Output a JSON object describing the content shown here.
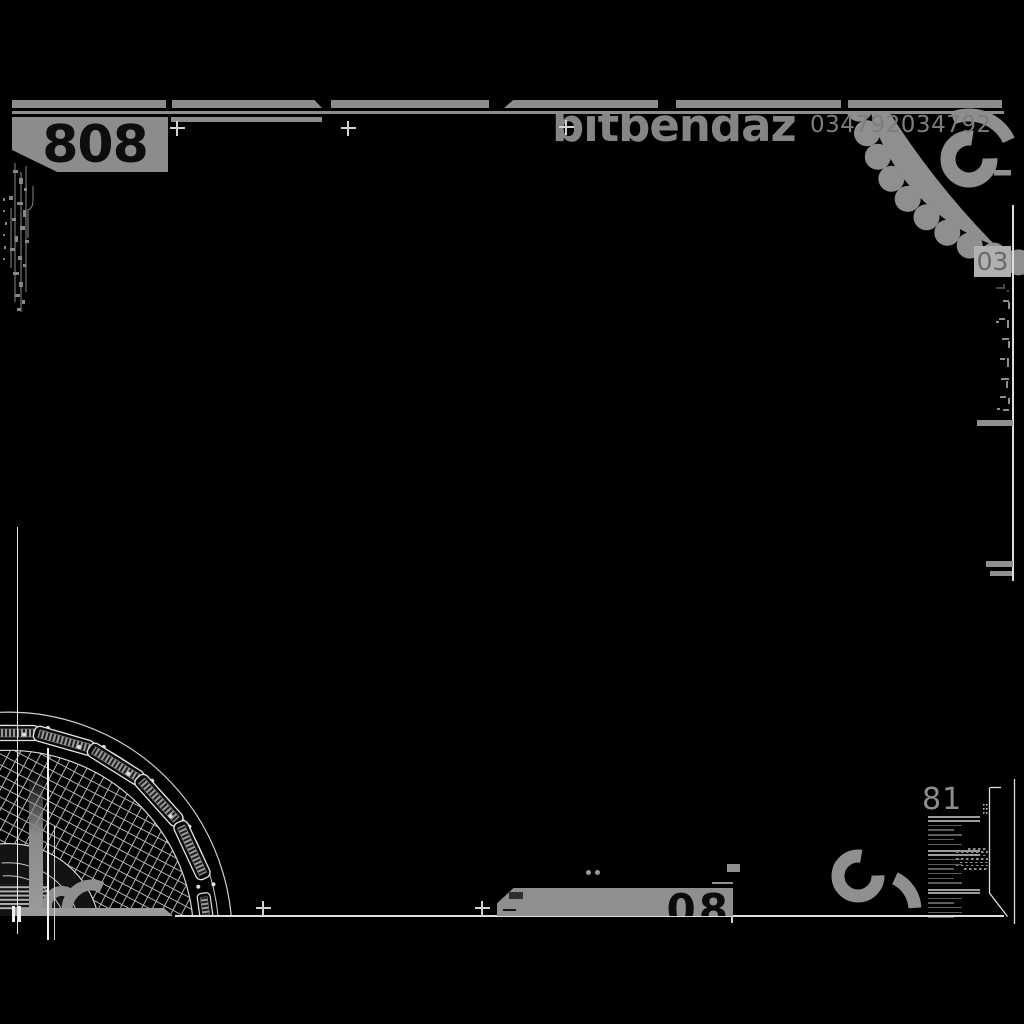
{
  "header": {
    "unit_number": "808",
    "brand": "bitbendaz",
    "serial": "034792034792",
    "badge": "03"
  },
  "footer": {
    "index_number": "81",
    "tab_number": "08"
  },
  "colors": {
    "background": "#000000",
    "accent_gray": "#8c8c8c",
    "light_line": "#dedede",
    "badge_bg": "#b0b0b0",
    "stencil_text": "#0d0d0d"
  }
}
